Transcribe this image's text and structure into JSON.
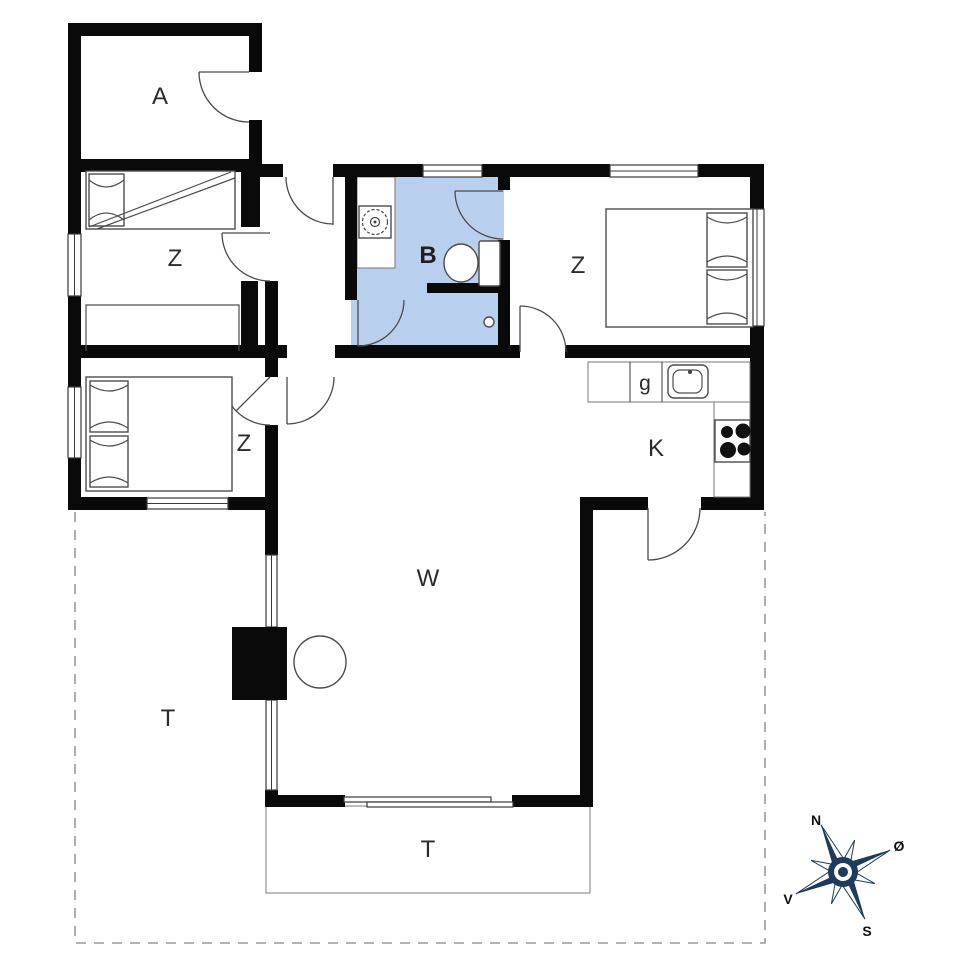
{
  "rooms": {
    "annex": "A",
    "bedroom_nw": "Z",
    "bedroom_sw": "Z",
    "bedroom_east": "Z",
    "bathroom": "B",
    "cupboard": "g",
    "kitchen": "K",
    "living_room": "W",
    "terrace_west": "T",
    "terrace_south": "T"
  },
  "compass": {
    "north": "N",
    "east": "Ø",
    "south": "S",
    "west": "V"
  },
  "colors": {
    "walls": "#0a0a0a",
    "bathroom_fill": "#b9cfee",
    "furniture_outline": "#4d4d4d",
    "boundary_dash": "#9a9a9a",
    "compass_navy": "#1e3a5c"
  }
}
